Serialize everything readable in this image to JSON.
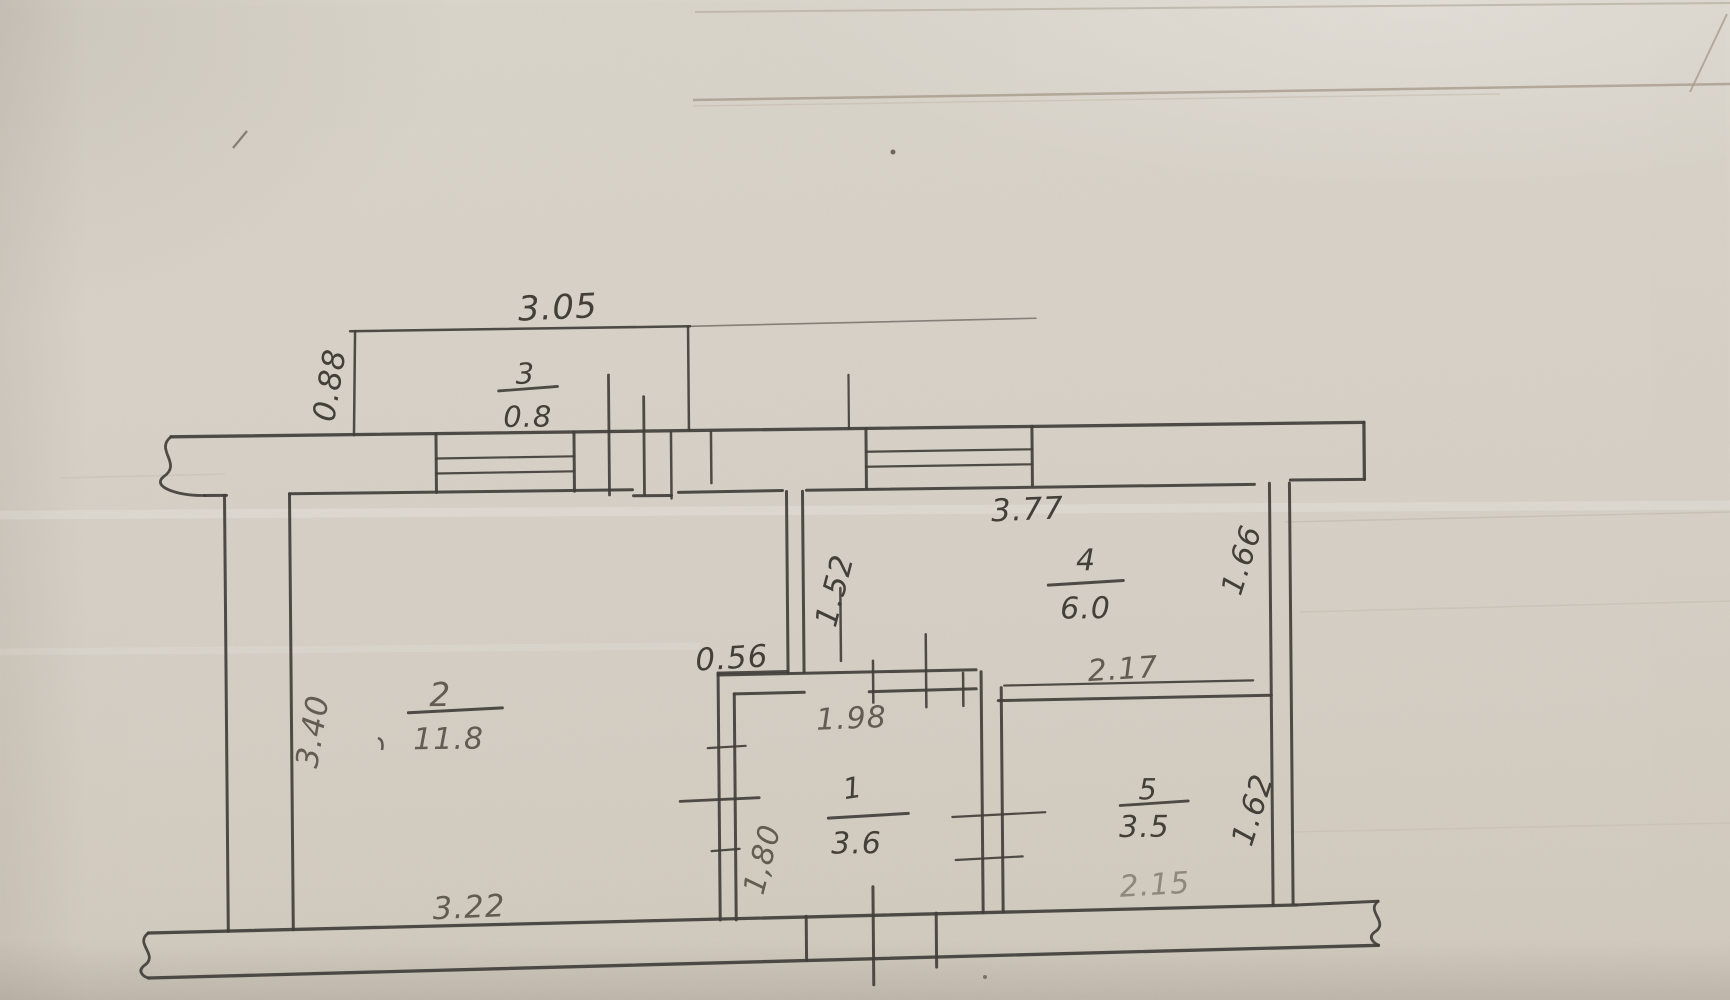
{
  "plan": {
    "rooms": [
      {
        "number": "1",
        "area": "3.6"
      },
      {
        "number": "2",
        "area": "11.8"
      },
      {
        "number": "3",
        "area": "0.8"
      },
      {
        "number": "4",
        "area": "6.0"
      },
      {
        "number": "5",
        "area": "3.5"
      }
    ],
    "dimensions": {
      "balcony_width": "3.05",
      "balcony_depth": "0.88",
      "room4_width": "3.77",
      "room4_depth": "1.66",
      "hall_partition_height": "1.52",
      "wall_segment": "0.56",
      "room1_width": "1.98",
      "room1_depth": "1,80",
      "room5_top_width": "2.17",
      "room5_depth": "1.62",
      "room5_bottom_width": "2.15",
      "room2_depth": "3.40",
      "room2_width": "3.22"
    },
    "colors": {
      "paper": "#d6d0c6",
      "ink": "#3f3c37",
      "pencil": "#5c564e",
      "pencil_light": "#8e877b"
    }
  }
}
